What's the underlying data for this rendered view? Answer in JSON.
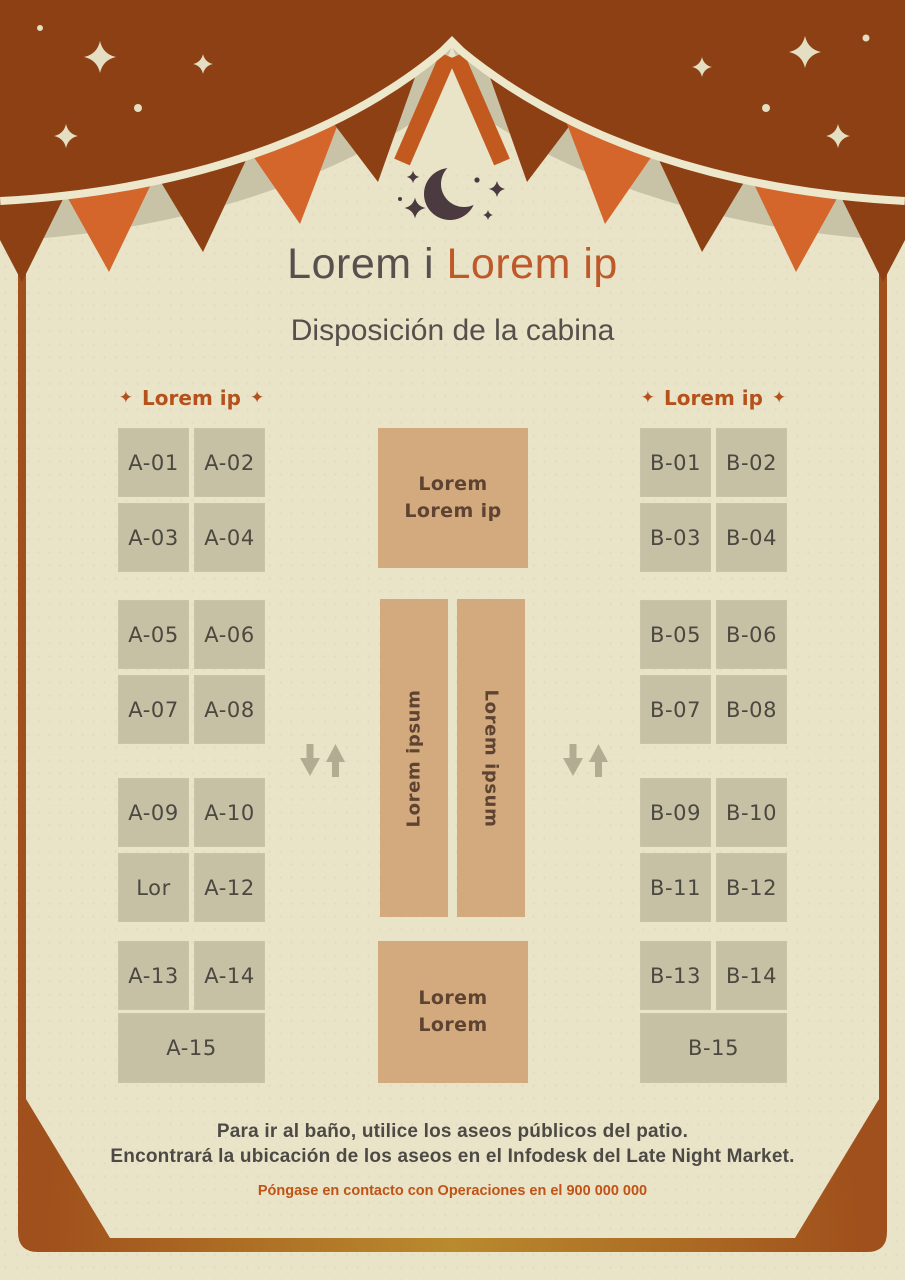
{
  "header": {
    "title_primary": "Lorem i",
    "title_accent": "Lorem ip",
    "subtitle": "Disposición de la cabina"
  },
  "decor": {
    "star_char": "✦"
  },
  "sections": {
    "left": {
      "header_label": "Lorem ip",
      "booths": [
        "A-01",
        "A-02",
        "A-03",
        "A-04",
        "A-05",
        "A-06",
        "A-07",
        "A-08",
        "A-09",
        "A-10",
        "Lor",
        "A-12",
        "A-13",
        "A-14"
      ],
      "wide_booth": "A-15"
    },
    "right": {
      "header_label": "Lorem ip",
      "booths": [
        "B-01",
        "B-02",
        "B-03",
        "B-04",
        "B-05",
        "B-06",
        "B-07",
        "B-08",
        "B-09",
        "B-10",
        "B-11",
        "B-12",
        "B-13",
        "B-14"
      ],
      "wide_booth": "B-15"
    }
  },
  "center_area": {
    "top_block_line1": "Lorem",
    "top_block_line2": "Lorem ip",
    "left_aisle_label": "Lorem ipsum",
    "right_aisle_label": "Lorem ipsum",
    "bottom_block_line1": "Lorem",
    "bottom_block_line2": "Lorem"
  },
  "footer": {
    "note_line1": "Para ir al baño, utilice los aseos públicos del patio.",
    "note_line2": "Encontrará la ubicación de los aseos en el Infodesk del Late Night Market.",
    "contact": "Póngase en contacto con Operaciones en el 900 000 000"
  },
  "colors": {
    "background": "#E9E3C7",
    "canopy_rust": "#8C4013",
    "flag_orange": "#D4652B",
    "shadow_band_tan": "#C8C2A6",
    "booth_fill": "#C6C0A4",
    "booth_text": "#4B4840",
    "block_fill": "#D3AA7E",
    "block_text": "#5E4332",
    "title_text": "#56514E",
    "title_accent": "#BE5A2A",
    "section_header": "#B5521C",
    "footer_text": "#4D4A45",
    "contact_text": "#C05315",
    "frame_rust": "#A0501C",
    "frame_gold": "#B98A2E",
    "moon": "#4B3A40",
    "arrow": "#B2AD92"
  }
}
